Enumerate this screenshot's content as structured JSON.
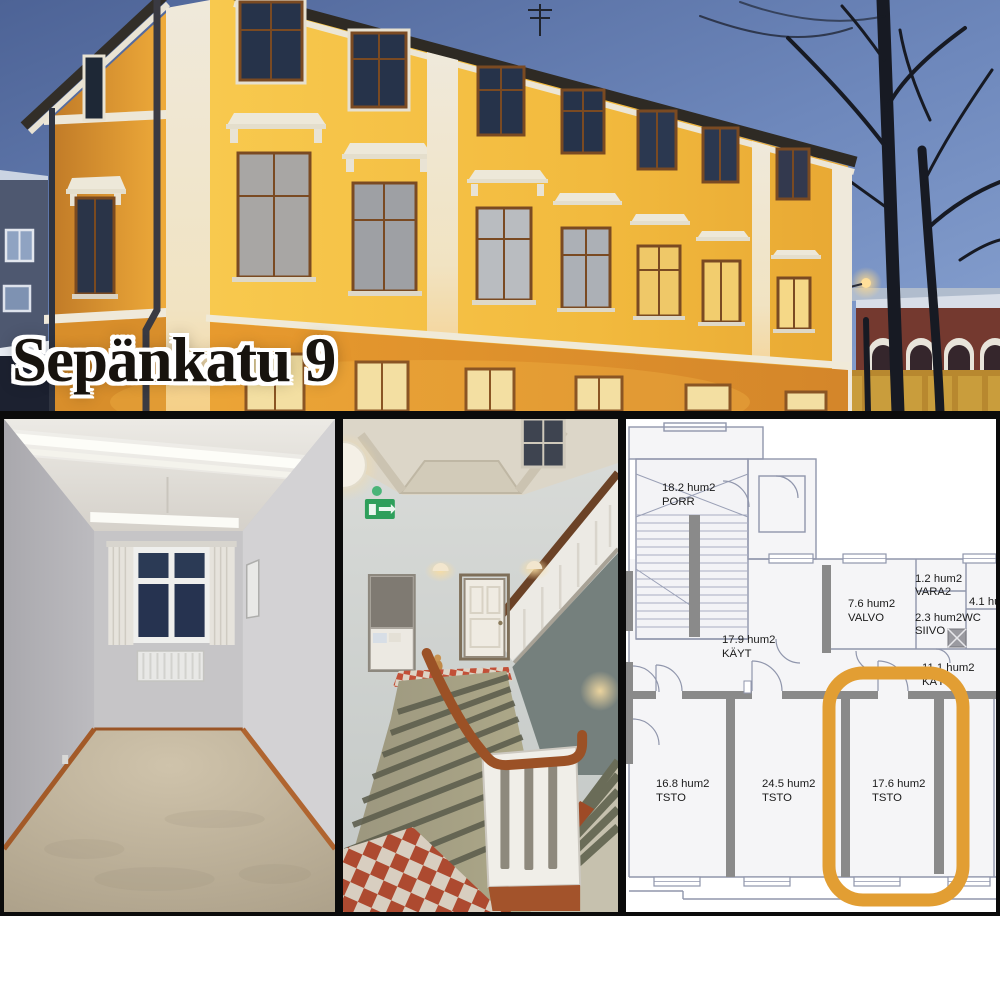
{
  "title": {
    "text": "Sepänkatu 9"
  },
  "collage": {
    "panels": [
      {
        "name": "building-exterior-photo",
        "description_icon": "building-photo"
      },
      {
        "name": "empty-room-photo",
        "description_icon": "room-photo"
      },
      {
        "name": "stairwell-photo",
        "description_icon": "stairwell-photo"
      },
      {
        "name": "floor-plan",
        "description_icon": "floorplan-drawing"
      }
    ]
  },
  "floorplan": {
    "rooms": {
      "porr": {
        "area": "18.2 hum2",
        "name": "PORR"
      },
      "kayt_main": {
        "area": "17.9 hum2",
        "name": "KÄYT"
      },
      "valvo": {
        "area": "7.6 hum2",
        "name": "VALVO"
      },
      "vara2": {
        "area": "1.2 hum2",
        "name": "VARA2"
      },
      "wc_siivo": {
        "area": "2.3 hum2WC",
        "name": "SIIVO"
      },
      "room_41": {
        "area": "4.1 hu",
        "name": ""
      },
      "kayt_2": {
        "area": "11.1 hum2",
        "name": "KÄYT"
      },
      "tsto_1": {
        "area": "16.8 hum2",
        "name": "TSTO"
      },
      "tsto_2": {
        "area": "24.5 hum2",
        "name": "TSTO"
      },
      "tsto_3": {
        "area": "17.6 hum2",
        "name": "TSTO"
      }
    },
    "highlighted_room": "17.6 hum2 TSTO",
    "colors": {
      "highlight": "#E29E33",
      "walls": "#8A8A8A"
    }
  },
  "photo_colors": {
    "facade_yellow": "#F2BA3E",
    "sky_dusk": "#6E88BC",
    "exit_sign_green": "#2E9F5B"
  }
}
